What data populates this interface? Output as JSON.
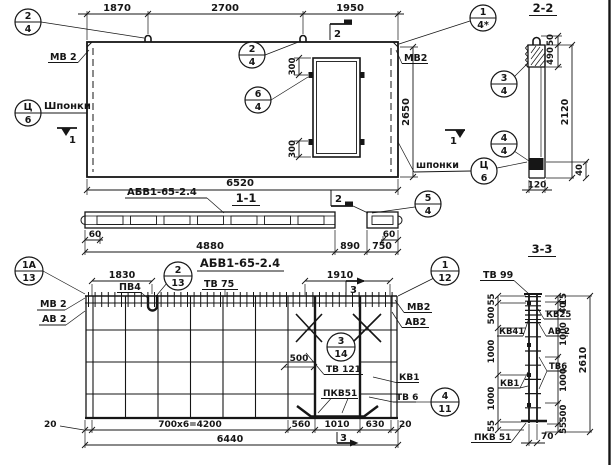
{
  "colors": {
    "ink": "#161616",
    "paper": "#ffffff"
  },
  "pv": {
    "dim_1870": "1870",
    "dim_2700": "2700",
    "dim_1950": "1950",
    "dim_2650": "2650",
    "dim_6520": "6520",
    "dim_300_top": "300",
    "dim_300_bot": "300",
    "c_tl": {
      "t": "2",
      "b": "4"
    },
    "c_hook": {
      "t": "2",
      "b": "4"
    },
    "c_door": {
      "t": "6",
      "b": "4"
    },
    "c_tr": {
      "t": "1",
      "b": "4*"
    },
    "c_key_left": {
      "t": "Ц",
      "b": "6"
    },
    "c_key_right": {
      "t": "Ц",
      "b": "6"
    },
    "label_mv2_left": "МВ 2",
    "label_mv2_right": "МВ2",
    "label_shponki_left": "Шпонки",
    "label_shponki_right": "шпонки",
    "marker_2_top": "2",
    "marker_1_left": "1",
    "marker_1_right": "1"
  },
  "s22": {
    "title": "2-2",
    "dim_50": "50",
    "dim_490": "490",
    "dim_2120": "2120",
    "dim_40": "40",
    "dim_120": "120",
    "c_top": {
      "t": "3",
      "b": "4"
    },
    "c_bot": {
      "t": "4",
      "b": "4"
    }
  },
  "s11": {
    "title": "1-1",
    "label_mark": "АБВ1-65-2.4",
    "marker_2": "2",
    "dim_60_l": "60",
    "dim_4880": "4880",
    "dim_890": "890",
    "dim_750": "750",
    "dim_60_r": "60",
    "c_right": {
      "t": "5",
      "b": "4"
    }
  },
  "rv": {
    "title": "АБВ1-65-2.4",
    "c_1a": {
      "t": "1А",
      "b": "13"
    },
    "c_2": {
      "t": "2",
      "b": "13"
    },
    "c_3": {
      "t": "3",
      "b": "14"
    },
    "c_1": {
      "t": "1",
      "b": "12"
    },
    "c_4": {
      "t": "4",
      "b": "11"
    },
    "dim_1830": "1830",
    "dim_1910": "1910",
    "dim_500": "500",
    "label_pv4": "ПВ4",
    "label_tv75": "ТВ 75",
    "label_mv2_left": "МВ 2",
    "label_av2_left": "АВ 2",
    "label_mv2_right": "МВ2",
    "label_av2_right": "АВ2",
    "label_tv121": "ТВ 121",
    "label_kv1": "КВ1",
    "label_tv6": "ТВ 6",
    "label_pkv51": "ПКВ51",
    "marker_3_top": "3",
    "marker_3_bot": "3",
    "dim_20_l": "20",
    "dim_4200": "700x6=4200",
    "dim_560": "560",
    "dim_1010": "1010",
    "dim_630": "630",
    "dim_20_r": "20",
    "dim_6440": "6440"
  },
  "s33": {
    "title": "3-3",
    "label_tv99": "ТВ 99",
    "label_kv25": "КВ25",
    "label_av2": "АВ 2",
    "label_kv41": "КВ41",
    "label_kv1": "КВ1",
    "label_tv6": "ТВ6",
    "label_pkv51": "ПКВ 51",
    "dim_55_t": "55",
    "dim_500_l": "500",
    "dim_1000_l1": "1000",
    "dim_1000_l2": "1000",
    "dim_55_b": "55",
    "dim_15": "15",
    "dim_40": "40",
    "dim_1000_r1": "1000",
    "dim_1000_r2": "1000",
    "dim_500_r": "500",
    "dim_55_r": "55",
    "dim_70": "70",
    "dim_2610": "2610"
  }
}
